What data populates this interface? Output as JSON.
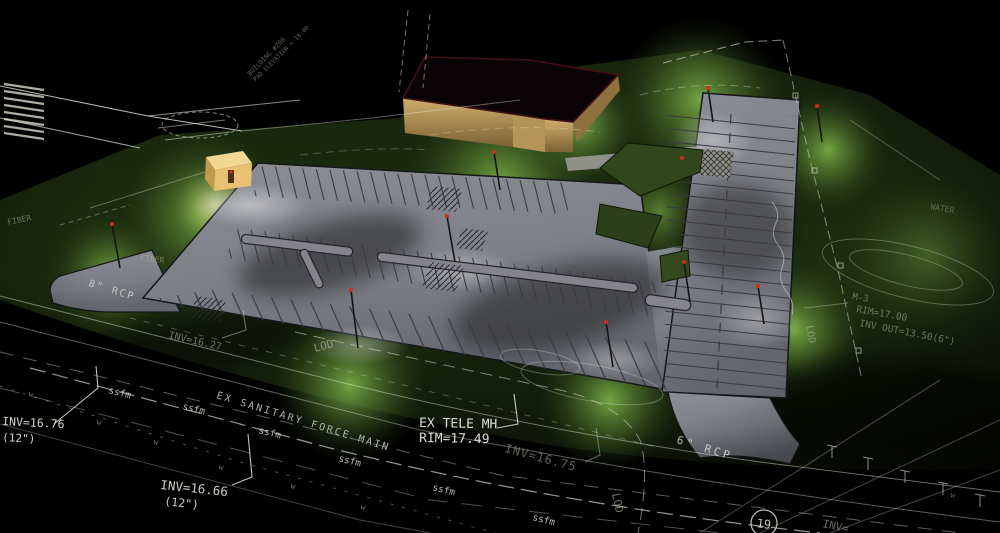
{
  "scene": {
    "type": "3d-site-lighting-rendering",
    "colors": {
      "background": "#000000",
      "grass_lit": "#6fa03f",
      "grass_dark": "#0c1206",
      "asphalt": "#80838a",
      "cad_line": "#e4e8da",
      "building_wall": "#c2a265",
      "building_roof": "#0a0406",
      "roof_edge": "#431017",
      "kiosk_wall": "#e8c175",
      "light_marker": "#d42a1e"
    }
  },
  "labels": {
    "inv_16_76": "INV=16.76",
    "inv_16_76_pipe": "(12\")",
    "inv_16_66": "INV=16.66",
    "inv_16_66_pipe": "(12\")",
    "force_main": "EX SANITARY FORCE MAIN",
    "tele_mh": "EX TELE MH",
    "tele_rim": "RIM=17.49",
    "inv_16_75": "INV=16.75",
    "inv_16_27": "INV=16.27",
    "rcp_8": "8\" RCP",
    "rcp_6": "6\" RCP",
    "fiber": "FIBER",
    "ssfm": "ssfm",
    "w_marker": "w",
    "lod": "LOD",
    "mh_3": "M-3",
    "rim_17_00": "RIM=17.00",
    "inv_out": "INV OUT=13.50(6\")",
    "water": "WATER",
    "route_19": "19",
    "inv_partial": "INV=",
    "building_name": "BUILDING #200",
    "building_pad": "PAD ELEVATION = 18.00"
  }
}
